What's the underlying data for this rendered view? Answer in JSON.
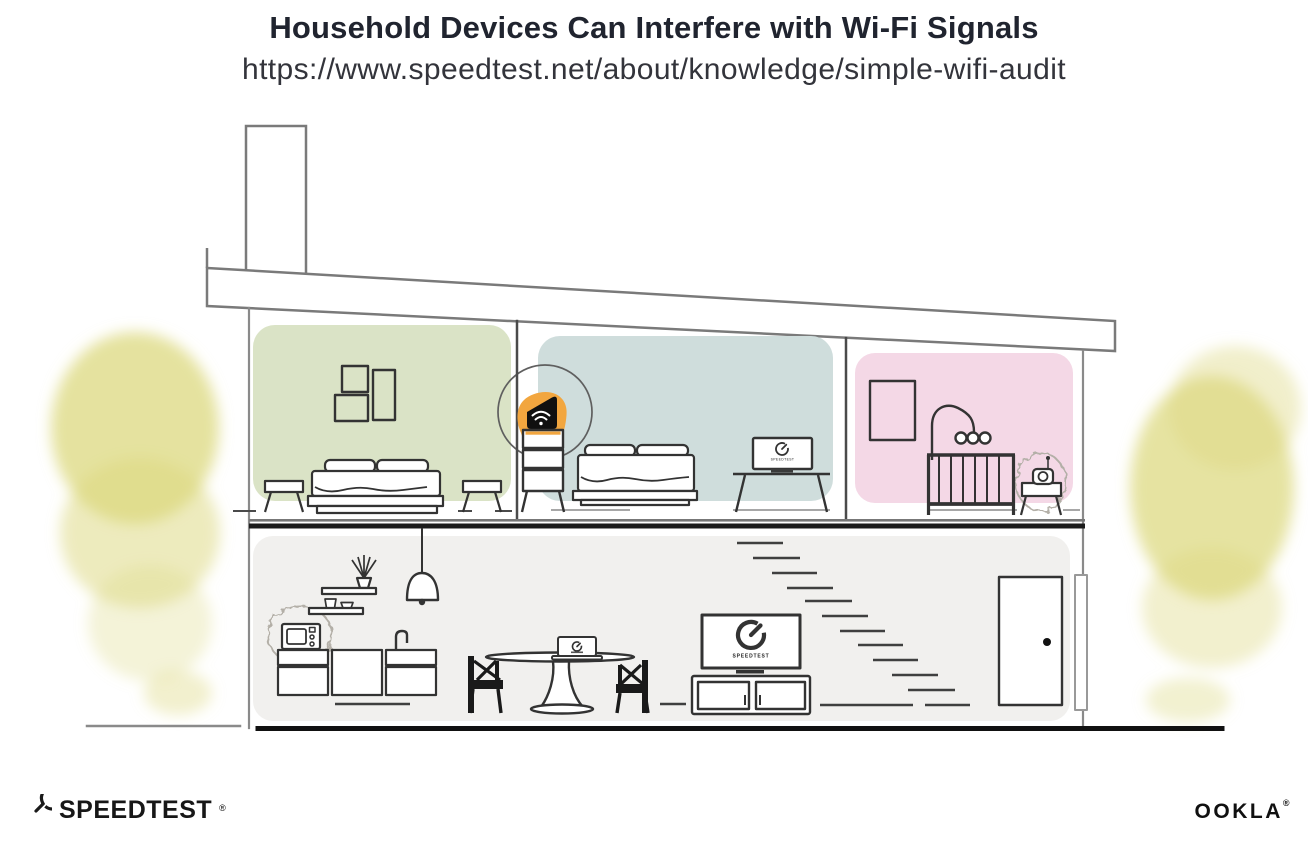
{
  "header": {
    "title": "Household Devices Can Interfere with Wi-Fi Signals",
    "url": "https://www.speedtest.net/about/knowledge/simple-wifi-audit"
  },
  "illustration": {
    "tv_screen_label": "SPEEDTEST",
    "monitor_screen_label": "SPEEDTEST",
    "colors": {
      "bedroom_left": "#dae3c6",
      "bedroom_middle": "#cfdddc",
      "nursery": "#f4d8e6",
      "living_floor": "#f1f0ee",
      "router_accent": "#f2a63f",
      "foliage": "#dcd87d"
    }
  },
  "footer": {
    "speedtest_wordmark": "SPEEDTEST",
    "speedtest_trademark": "®",
    "ookla_wordmark": "OOKLA",
    "ookla_trademark": "®"
  }
}
